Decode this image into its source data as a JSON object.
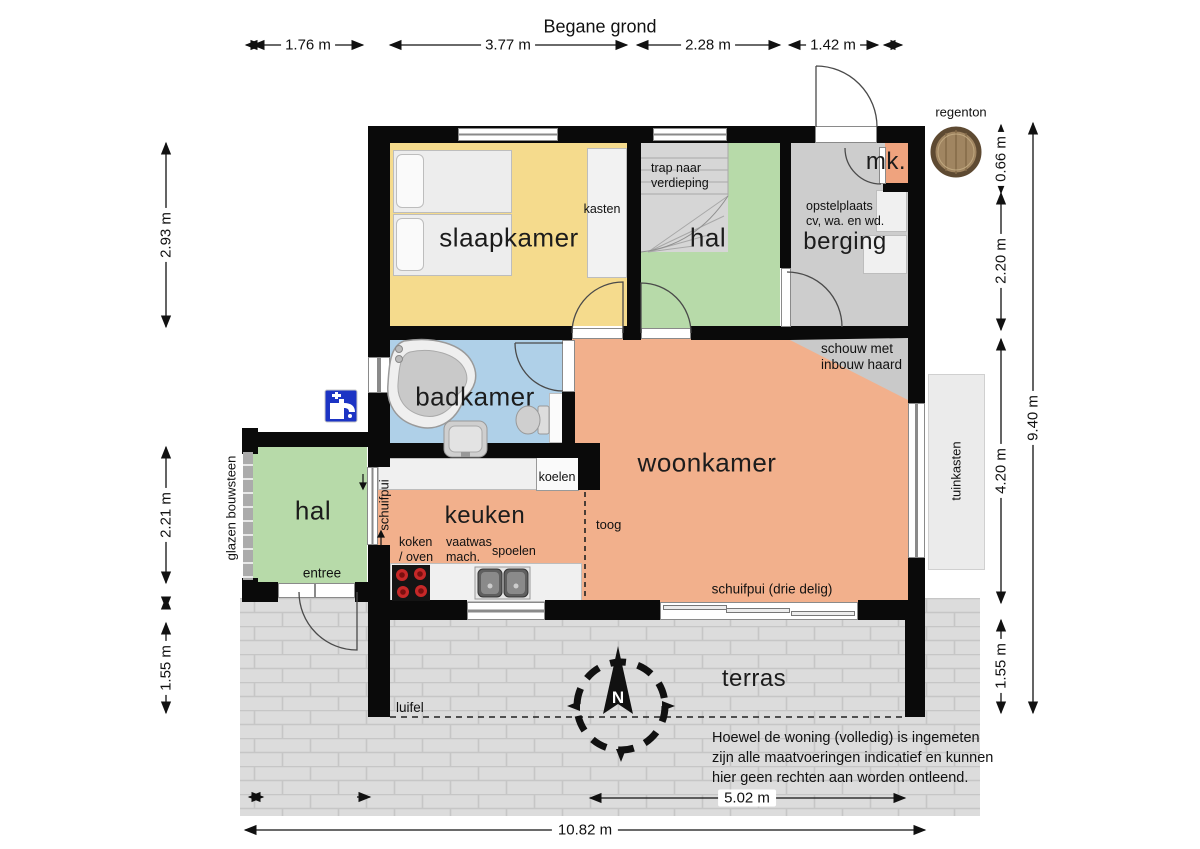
{
  "title": "Begane grond",
  "compass_label": "N",
  "rooms": {
    "slaapkamer": "slaapkamer",
    "hal_boven": "hal",
    "berging": "berging",
    "mk": "mk.",
    "badkamer": "badkamer",
    "woonkamer": "woonkamer",
    "keuken": "keuken",
    "hal_entree": "hal",
    "terras": "terras"
  },
  "annotations": {
    "kasten": "kasten",
    "trap": "trap naar verdieping",
    "opstelplaats_line1": "opstelplaats",
    "opstelplaats_line2": "cv, wa. en wd.",
    "koelen": "koelen",
    "toog": "toog",
    "schuifpui": "schuifpui",
    "schuifpui_drie": "schuifpui (drie delig)",
    "koken_line1": "koken",
    "koken_line2": "/ oven",
    "vaatwas_line1": "vaatwas",
    "vaatwas_line2": "mach.",
    "spoelen": "spoelen",
    "entree": "entree",
    "glazen_bouwsteen": "glazen bouwsteen",
    "luifel": "luifel",
    "schouw_line1": "schouw met",
    "schouw_line2": "inbouw haard",
    "tuinkasten": "tuinkasten",
    "regenton": "regenton"
  },
  "dimensions": {
    "top": [
      "1.76 m",
      "3.77 m",
      "2.28 m",
      "1.42 m"
    ],
    "left": [
      "2.93 m",
      "2.21 m",
      "1.55 m"
    ],
    "right": [
      "0.66 m",
      "2.20 m",
      "4.20 m",
      "1.55 m"
    ],
    "right_total": "9.40 m",
    "bottom": [
      "5.02 m",
      "10.82 m"
    ]
  },
  "disclaimer": [
    "Hoewel de woning (volledig) is ingemeten",
    "zijn alle maatvoeringen indicatief en kunnen",
    "hier geen rechten aan worden ontleend."
  ],
  "colors": {
    "wall": "#0a0a0a",
    "slaapkamer": "#F5DB8D",
    "hal": "#B7DAA9",
    "berging": "#CDCDCD",
    "mk": "#EFA37E",
    "badkamer": "#AFD0E8",
    "woonkamer": "#F2B08C",
    "stairs": "#D6D6D6",
    "terras": "#DCDCDC",
    "brickline": "#C6C6C6",
    "tuinkasten": "#EBEBEB",
    "furniture": "#F0F0F0",
    "furnitureborder": "#BDBDBD",
    "tapblue": "#1C34C4",
    "regenton": "#A08561",
    "regentonrim": "#5E4A32"
  }
}
